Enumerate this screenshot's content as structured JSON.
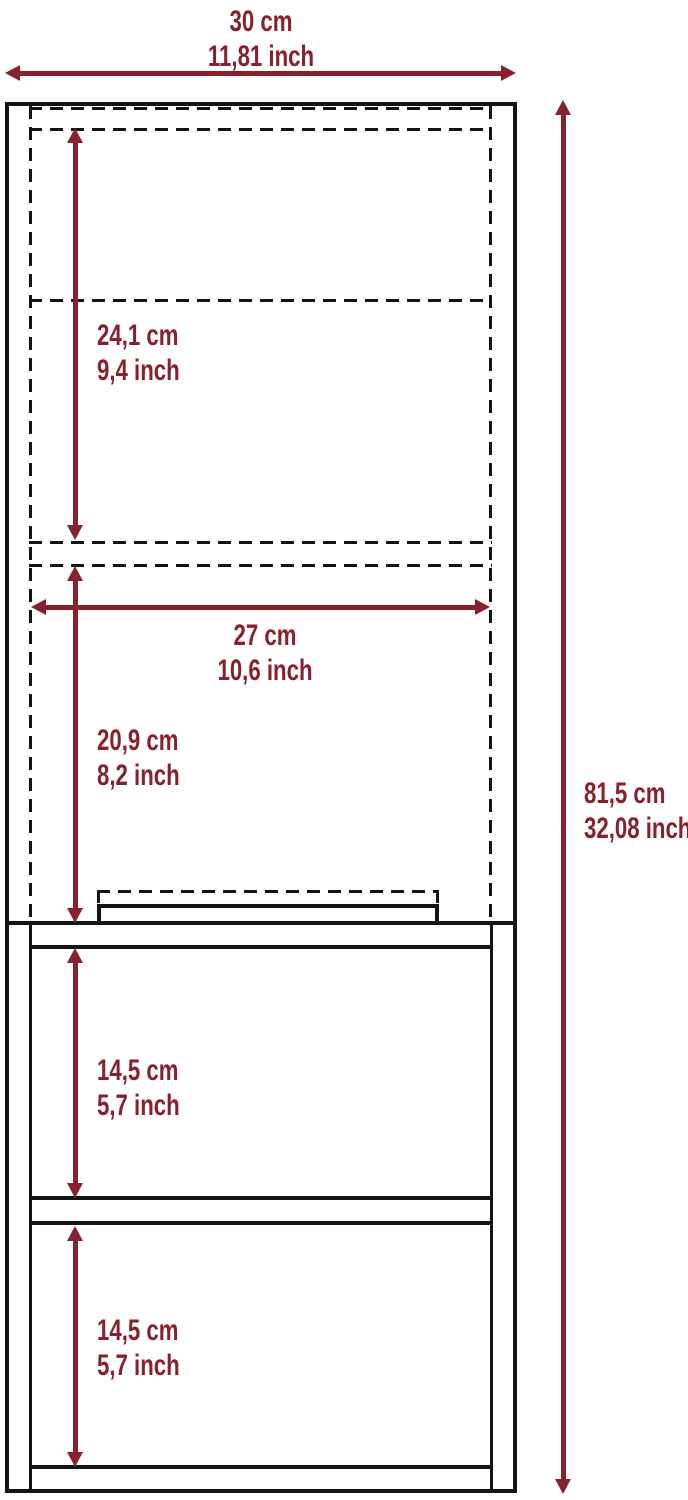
{
  "diagram": {
    "title": "furniture-dimension-diagram",
    "colors": {
      "dimension_accent": "#87212e",
      "outline": "#141414",
      "background": "#ffffff"
    },
    "measurements": {
      "overall_width": {
        "cm": "30 cm",
        "inch": "11,81 inch"
      },
      "overall_height": {
        "cm": "81,5 cm",
        "inch": "32,08 inch"
      },
      "upper_door_height": {
        "cm": "24,1 cm",
        "inch": "9,4 inch"
      },
      "inner_width": {
        "cm": "27 cm",
        "inch": "10,6 inch"
      },
      "lower_door_height": {
        "cm": "20,9 cm",
        "inch": "8,2 inch"
      },
      "upper_shelf_space": {
        "cm": "14,5 cm",
        "inch": "5,7 inch"
      },
      "lower_shelf_space": {
        "cm": "14,5 cm",
        "inch": "5,7 inch"
      }
    }
  }
}
